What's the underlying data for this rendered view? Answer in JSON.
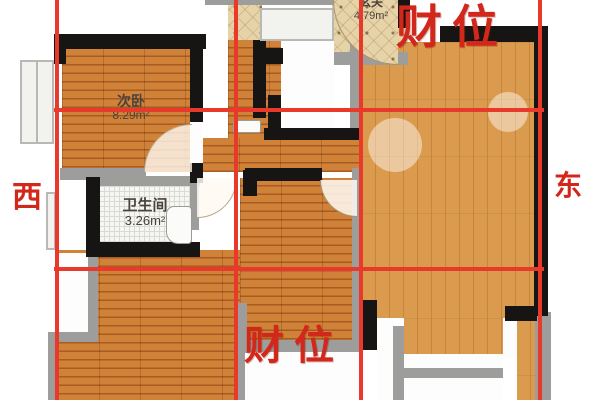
{
  "compass": {
    "west": "西",
    "east": "东"
  },
  "wealth": {
    "top": "财位",
    "bottom": "财位"
  },
  "rooms": {
    "secondary_bedroom": {
      "name": "次卧",
      "area": "8.29m²"
    },
    "bathroom": {
      "name": "卫生间",
      "area": "3.26m²"
    },
    "entry": {
      "name": "玄关",
      "area": "4.79m²"
    }
  },
  "colors": {
    "wealth_label": "#d2271b",
    "compass_label": "#d2271b",
    "grid_line": "#e8392a",
    "wood_floor": "#c4722c",
    "wood_floor_light": "#d9974a",
    "entry_floor": "#e7d3a8",
    "bathroom_floor": "#f6f6f3",
    "wall": "#171513"
  }
}
